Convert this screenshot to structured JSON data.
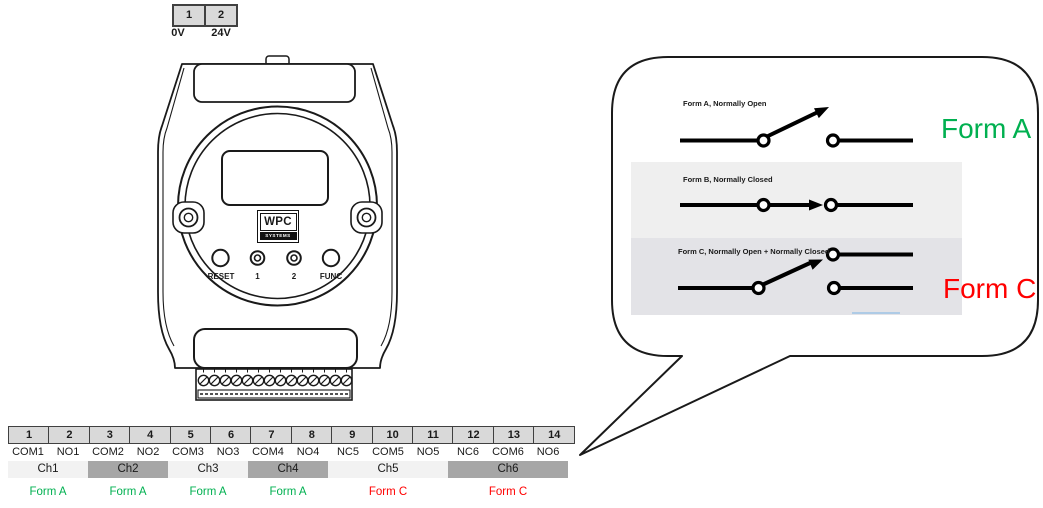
{
  "power_table": {
    "pins": [
      {
        "number": "1",
        "label": "0V"
      },
      {
        "number": "2",
        "label": "24V"
      }
    ]
  },
  "device": {
    "logo": "WPC",
    "logo_sub": "SYSTEMS",
    "buttons": [
      {
        "label": "RESET"
      },
      {
        "label": "1"
      },
      {
        "label": "2"
      },
      {
        "label": "FUNC"
      }
    ]
  },
  "callout": {
    "form_a_title": "Form A, Normally Open",
    "form_b_title": "Form B, Normally Closed",
    "form_c_title": "Form C, Normally Open + Normally Closed",
    "form_a_big": "Form A",
    "form_c_big": "Form C"
  },
  "pin_table": {
    "pins": [
      {
        "number": "1",
        "label": "COM1"
      },
      {
        "number": "2",
        "label": "NO1"
      },
      {
        "number": "3",
        "label": "COM2"
      },
      {
        "number": "4",
        "label": "NO2"
      },
      {
        "number": "5",
        "label": "COM3"
      },
      {
        "number": "6",
        "label": "NO3"
      },
      {
        "number": "7",
        "label": "COM4"
      },
      {
        "number": "8",
        "label": "NO4"
      },
      {
        "number": "9",
        "label": "NC5"
      },
      {
        "number": "10",
        "label": "COM5"
      },
      {
        "number": "11",
        "label": "NO5"
      },
      {
        "number": "12",
        "label": "NC6"
      },
      {
        "number": "13",
        "label": "COM6"
      },
      {
        "number": "14",
        "label": "NO6"
      }
    ],
    "channels": [
      {
        "label": "Ch1",
        "form": "Form A"
      },
      {
        "label": "Ch2",
        "form": "Form A"
      },
      {
        "label": "Ch3",
        "form": "Form A"
      },
      {
        "label": "Ch4",
        "form": "Form A"
      },
      {
        "label": "Ch5",
        "form": "Form C"
      },
      {
        "label": "Ch6",
        "form": "Form C"
      }
    ]
  },
  "colors": {
    "form_a_green": "#00B050",
    "form_c_red": "#FF0000",
    "pin_cell_gray": "#d9d9d9",
    "channel_light": "#f2f2f2",
    "channel_dark": "#a6a6a6"
  }
}
